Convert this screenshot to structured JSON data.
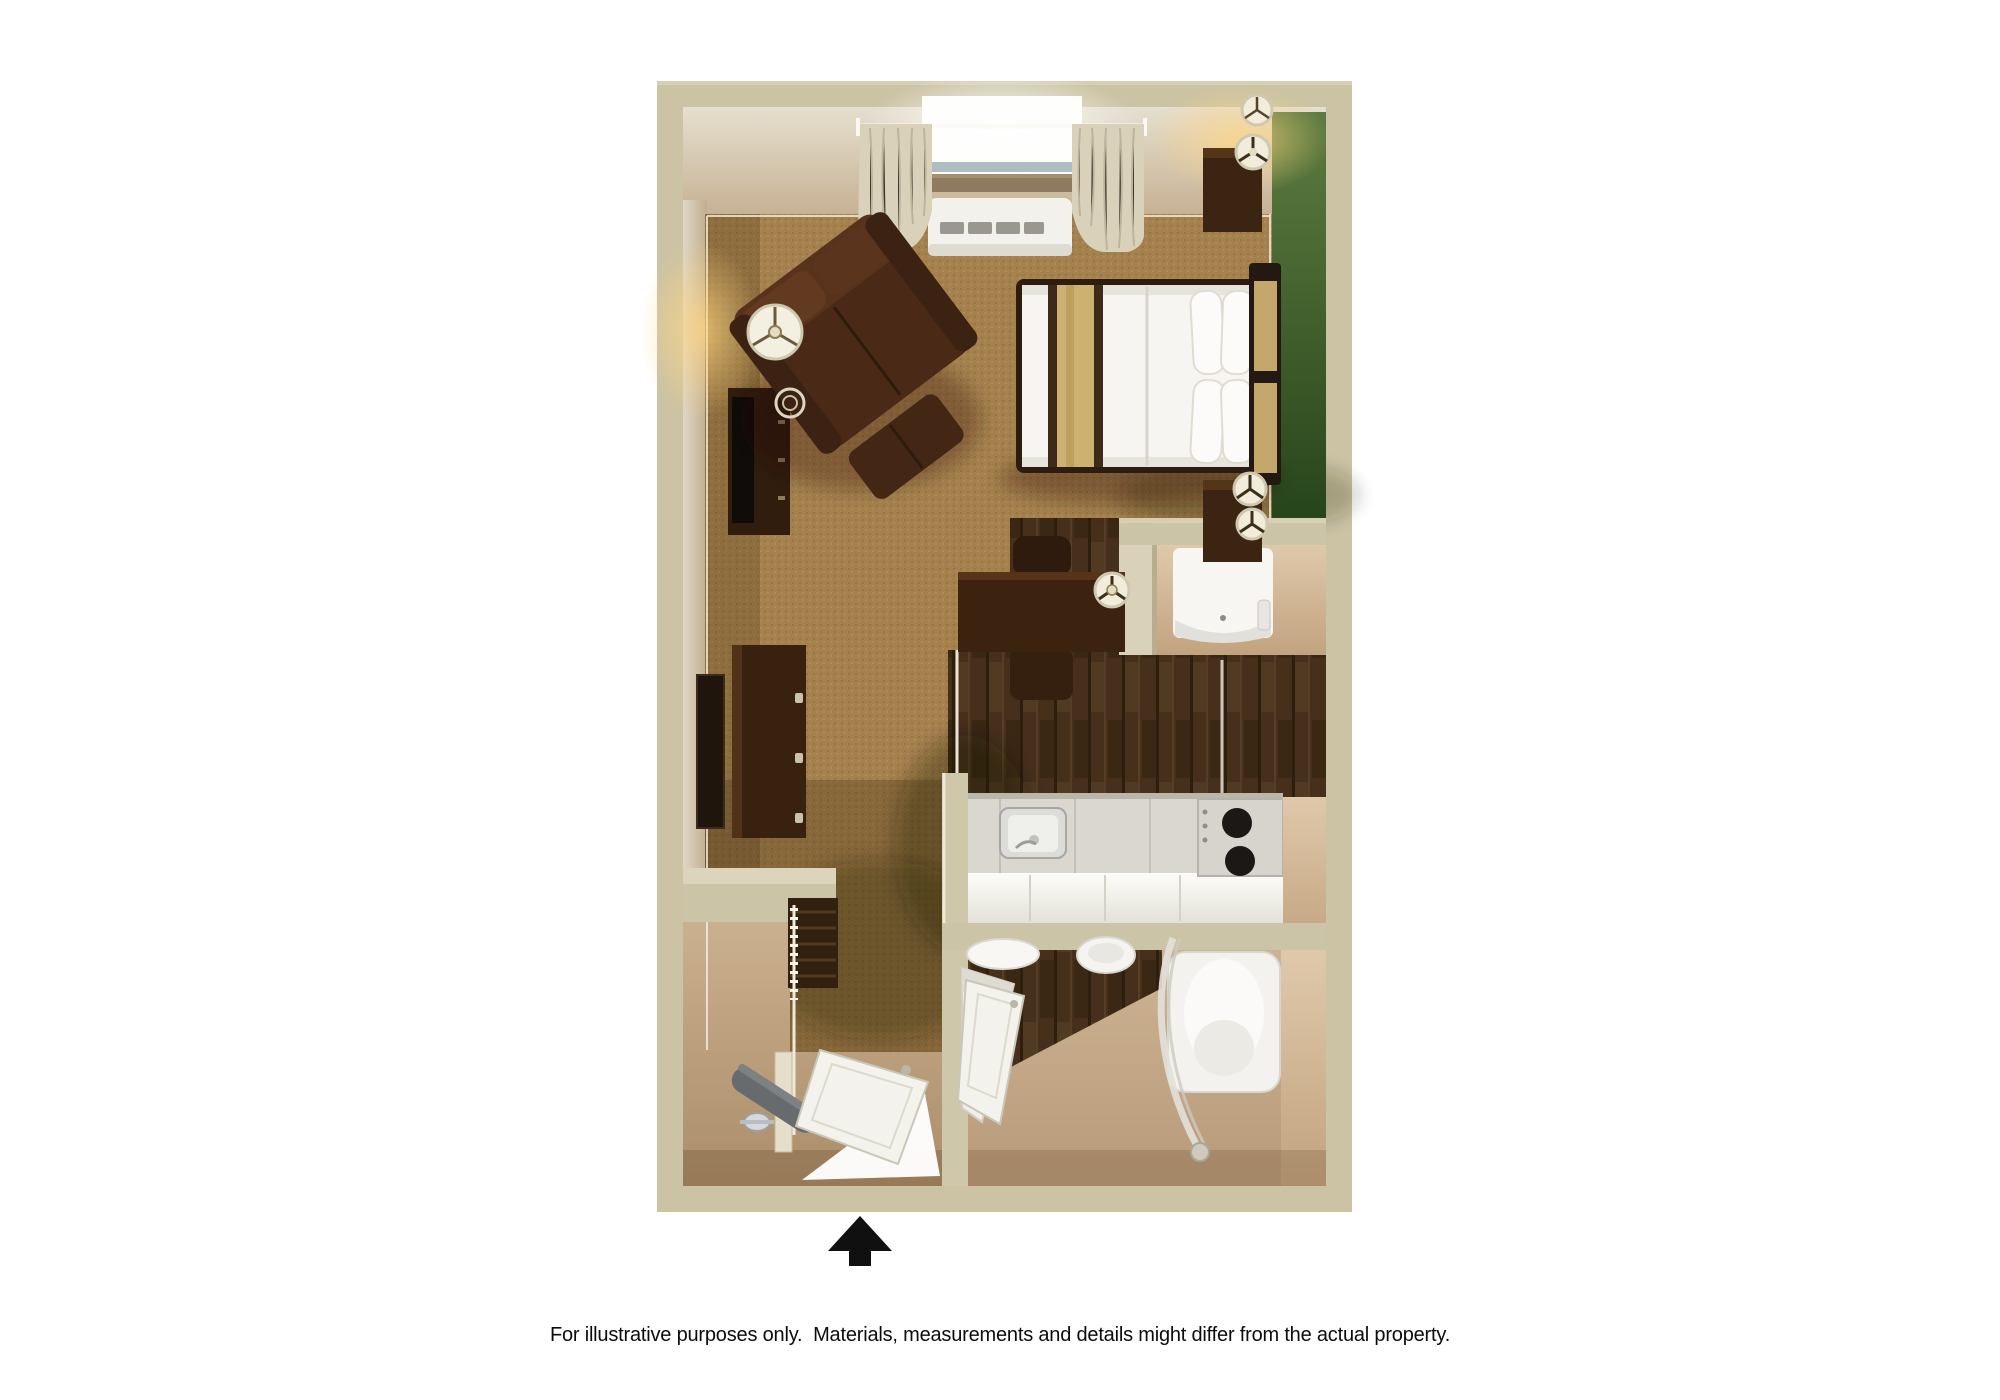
{
  "page": {
    "background": "#ffffff",
    "disclaimer": "For illustrative purposes only.  Materials, measurements and details might differ from the actual property."
  },
  "floor_plan": {
    "kind": "3d-rendered-studio-suite-floor-plan",
    "entrance_arrow_icon": "black-up-arrow",
    "colors": {
      "outer_wall": "#cbc3a4",
      "interior_wall_beige": "#ddd6c5",
      "interior_wall_tan": "#c7b295",
      "accent_wall_green": "#4a6a33",
      "carpet": "#a37f4b",
      "kitchen_wood_floor": "#45301c",
      "entry_vinyl_floor": "#c2a685",
      "bathroom_vinyl_floor": "#c6ab8d",
      "counter": "#dad7ce",
      "fixtures_white": "#f6f5f1",
      "furniture_dark_wood": "#3a2310",
      "bed_runner_tan": "#cdb170",
      "arrow_black": "#101010"
    },
    "rooms": [
      {
        "name": "bedroom-living-area",
        "floor": "carpet"
      },
      {
        "name": "kitchenette",
        "floor": "dark-wood"
      },
      {
        "name": "bathroom",
        "floor": "vinyl"
      },
      {
        "name": "entry-closet",
        "floor": "vinyl"
      }
    ],
    "furniture": [
      {
        "name": "window-with-curtains",
        "room": "bedroom-living-area"
      },
      {
        "name": "ptac-air-conditioner",
        "room": "bedroom-living-area"
      },
      {
        "name": "queen-bed-with-headboard-and-pillows",
        "room": "bedroom-living-area"
      },
      {
        "name": "nightstand-with-double-lamp",
        "room": "bedroom-living-area",
        "count": 2
      },
      {
        "name": "recliner-armchair-with-ottoman",
        "room": "bedroom-living-area"
      },
      {
        "name": "floor-lamp",
        "room": "bedroom-living-area"
      },
      {
        "name": "tv-console-with-flat-tv",
        "room": "bedroom-living-area"
      },
      {
        "name": "dresser-with-mirror",
        "room": "bedroom-living-area"
      },
      {
        "name": "work-desk-with-chair-and-lamp",
        "room": "kitchenette"
      },
      {
        "name": "refrigerator",
        "room": "kitchenette"
      },
      {
        "name": "kitchen-counter-with-sink",
        "room": "kitchenette"
      },
      {
        "name": "two-burner-stove",
        "room": "kitchenette"
      },
      {
        "name": "closet-shelf-and-hanging-rod",
        "room": "entry-closet"
      },
      {
        "name": "ironing-board-with-iron",
        "room": "entry-closet"
      },
      {
        "name": "entry-door-open",
        "room": "entry-closet"
      },
      {
        "name": "bathroom-door-open",
        "room": "bathroom"
      },
      {
        "name": "vanity-with-sink",
        "room": "bathroom"
      },
      {
        "name": "toilet",
        "room": "bathroom"
      },
      {
        "name": "bathtub-with-shower-curtain",
        "room": "bathroom"
      }
    ]
  }
}
